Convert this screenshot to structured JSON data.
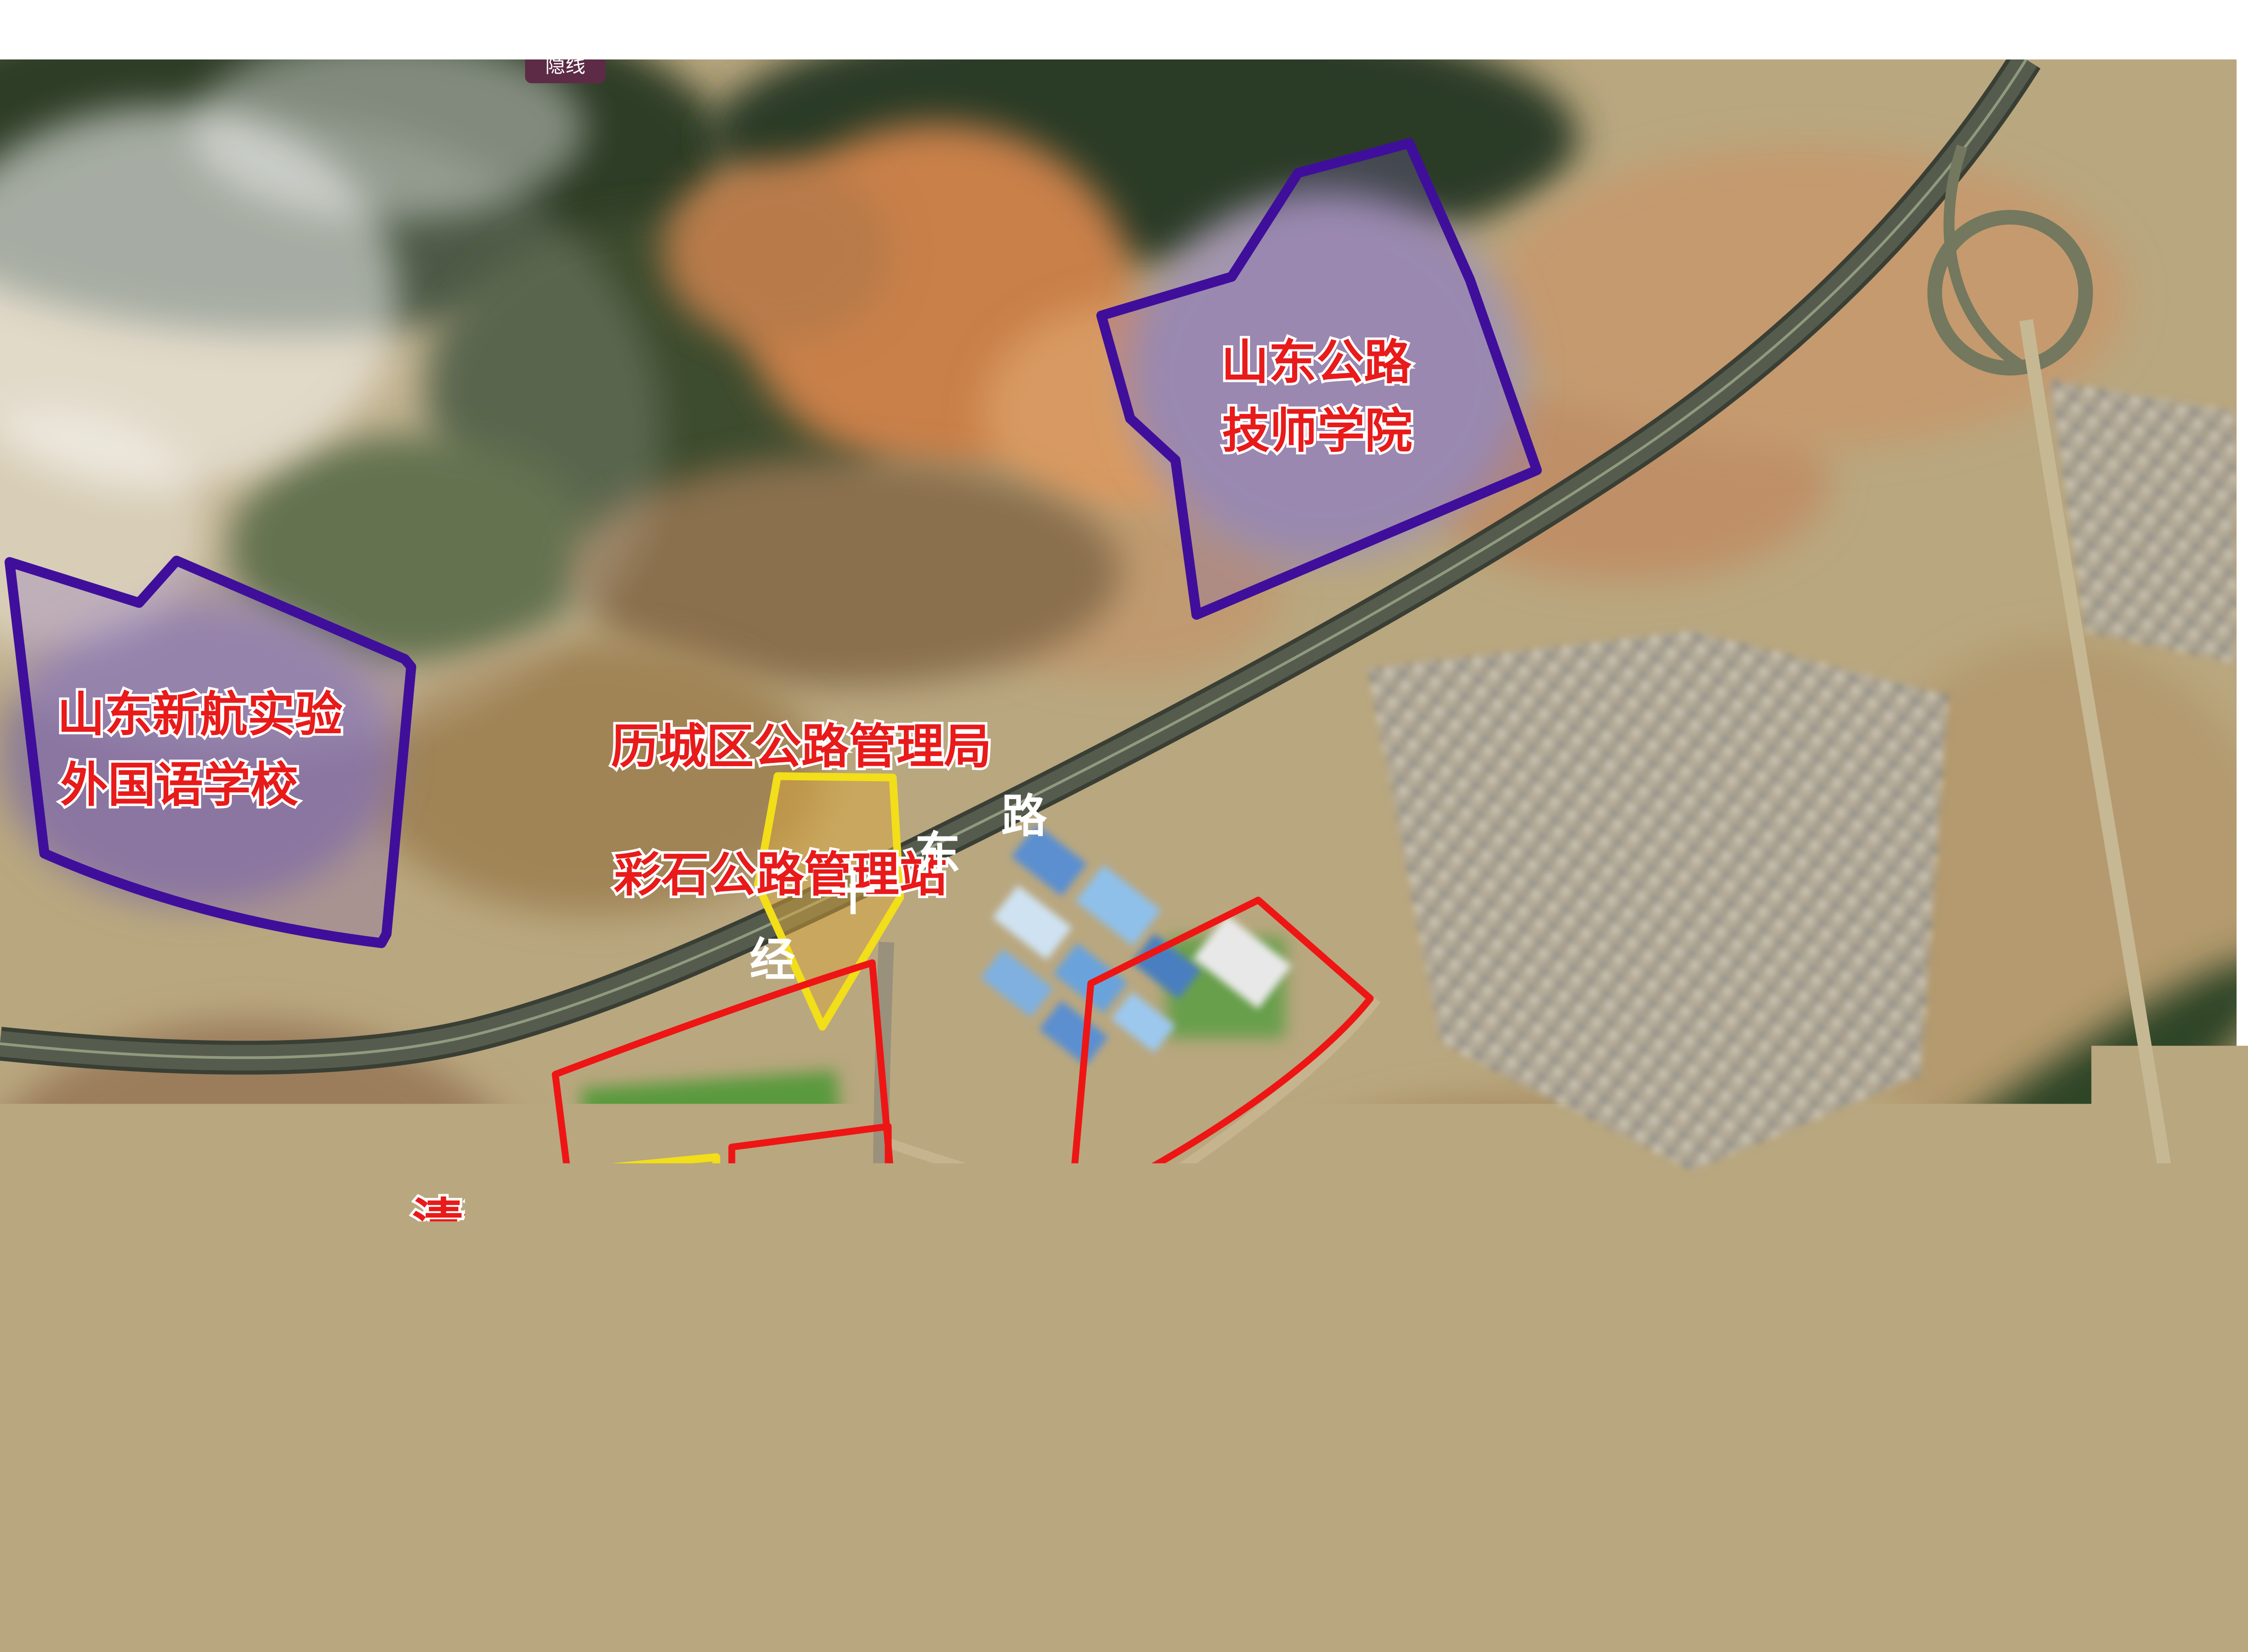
{
  "app": {
    "hide_lines_button": "隐线"
  },
  "map": {
    "scale_bar_label": "200米",
    "road_labels": {
      "jingshidong": {
        "name": "经十东路",
        "chars": [
          "经",
          "十",
          "东",
          "路"
        ]
      },
      "cailong": {
        "name": "彩龙路",
        "chars": [
          "彩",
          "龙",
          "路"
        ]
      }
    },
    "region_labels": {
      "xinhang_line1": "山东新航实验",
      "xinhang_line2": "外国语学校",
      "college_line1": "山东公路",
      "college_line2": "技师学院",
      "station_line1": "历城区公路管理局",
      "station_line2": "彩石公路管理站",
      "tomb": "清河太夫人墓",
      "medical_platform": "医疗器械创新和监管服务大平台",
      "food_platform": "食品药品创新和监管服务大平台"
    },
    "colors": {
      "annotation_red": "#ee1515",
      "annotation_yellow": "#f2de19",
      "annotation_purple": "#3f0f9b",
      "label_red": "#e81a1a",
      "button_bg": "#5d2b45"
    }
  }
}
